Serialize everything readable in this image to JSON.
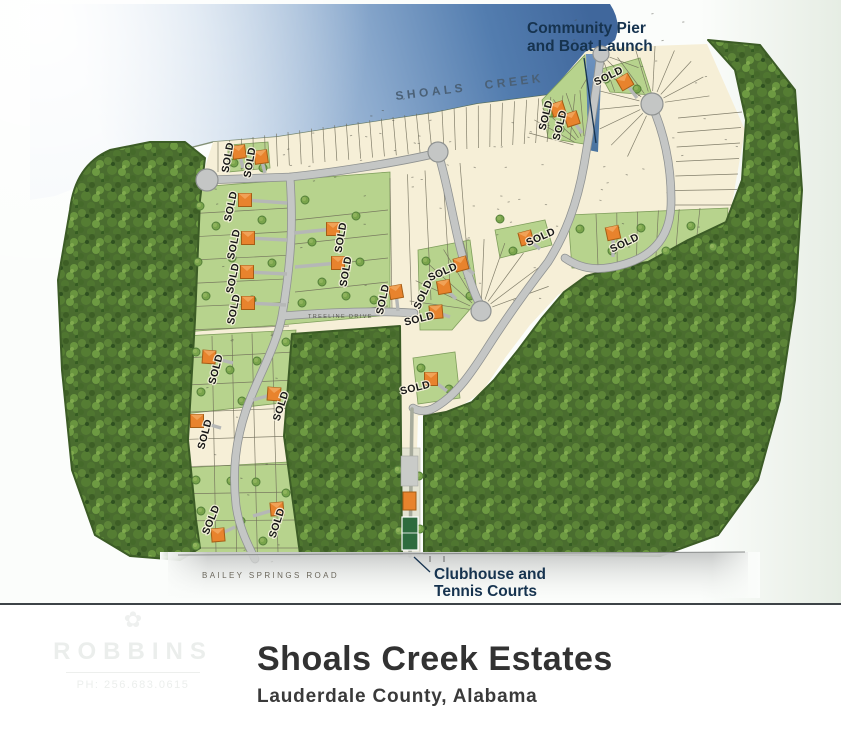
{
  "page": {
    "title": "Shoals Creek Estates",
    "subtitle": "Lauderdale County, Alabama"
  },
  "map_labels": {
    "creek_name": "SHOALS CREEK",
    "pier_label_line1": "Community Pier",
    "pier_label_line2": "and Boat Launch",
    "clubhouse_label_line1": "Clubhouse and",
    "clubhouse_label_line2": "Tennis Courts",
    "bailey_road": "BAILEY SPRINGS ROAD",
    "treeline_drive": "TREELINE DRIVE",
    "sold_text": "SOLD"
  },
  "watermark": {
    "name": "ROBBINS",
    "phone": "PH: 256.683.0615"
  },
  "colors": {
    "water_deep": "#40679c",
    "water_light": "#f3f7fa",
    "forest_green": "#4a6d2f",
    "lot_cream": "#f6efd7",
    "lot_green": "#b7d38d",
    "road_gray": "#c4c6c5",
    "road_edge": "#8f9291",
    "sold_orange": "#e8832d",
    "sold_orange_border": "#a55d15",
    "sold_roof_highlight": "#f2a55c",
    "callout_navy": "#16334f",
    "title_text": "#323232",
    "tennis_court_green": "#2e6b3e"
  },
  "sold_markers": [
    {
      "x": 239,
      "y": 152,
      "hr": -8,
      "ldx": -8,
      "ldy": 6,
      "lrot": -80,
      "d": [
        4,
        16
      ]
    },
    {
      "x": 261,
      "y": 157,
      "hr": -8,
      "ldx": -8,
      "ldy": 6,
      "lrot": -80,
      "d": [
        4,
        16
      ]
    },
    {
      "x": 245,
      "y": 200,
      "hr": 0,
      "ldx": -11,
      "ldy": 7,
      "lrot": -78,
      "d": [
        42,
        3
      ]
    },
    {
      "x": 248,
      "y": 238,
      "hr": 0,
      "ldx": -11,
      "ldy": 7,
      "lrot": -78,
      "d": [
        39,
        2
      ]
    },
    {
      "x": 247,
      "y": 272,
      "hr": 0,
      "ldx": -11,
      "ldy": 7,
      "lrot": -78,
      "d": [
        40,
        2
      ]
    },
    {
      "x": 248,
      "y": 303,
      "hr": 0,
      "ldx": -11,
      "ldy": 7,
      "lrot": -78,
      "d": [
        38,
        2
      ]
    },
    {
      "x": 333,
      "y": 229,
      "hr": 0,
      "ldx": 11,
      "ldy": 9,
      "lrot": -80,
      "d": [
        -39,
        4
      ]
    },
    {
      "x": 338,
      "y": 263,
      "hr": 0,
      "ldx": 11,
      "ldy": 9,
      "lrot": -80,
      "d": [
        -43,
        4
      ]
    },
    {
      "x": 396,
      "y": 292,
      "hr": -10,
      "ldx": -10,
      "ldy": 8,
      "lrot": -78,
      "d": [
        2,
        19
      ]
    },
    {
      "x": 526,
      "y": 238,
      "hr": -15,
      "ldx": 16,
      "ldy": 2,
      "lrot": -24,
      "d": [
        14,
        11
      ]
    },
    {
      "x": 461,
      "y": 264,
      "hr": -15,
      "ldx": -17,
      "ldy": 11,
      "lrot": -24,
      "d": [
        13,
        10
      ]
    },
    {
      "x": 444,
      "y": 287,
      "hr": -10,
      "ldx": -18,
      "ldy": 9,
      "lrot": -65,
      "d": [
        12,
        12
      ]
    },
    {
      "x": 436,
      "y": 312,
      "hr": -5,
      "ldx": -16,
      "ldy": 10,
      "lrot": -14,
      "d": [
        14,
        5
      ]
    },
    {
      "x": 613,
      "y": 233,
      "hr": -12,
      "ldx": 13,
      "ldy": 13,
      "lrot": -26,
      "d": [
        0,
        24
      ]
    },
    {
      "x": 558,
      "y": 109,
      "hr": -18,
      "ldx": -9,
      "ldy": 7,
      "lrot": -76,
      "d": [
        10,
        15
      ]
    },
    {
      "x": 572,
      "y": 119,
      "hr": -18,
      "ldx": -9,
      "ldy": 7,
      "lrot": -76,
      "d": [
        10,
        14
      ]
    },
    {
      "x": 625,
      "y": 82,
      "hr": -30,
      "ldx": -15,
      "ldy": -3,
      "lrot": -26,
      "d": [
        12,
        16
      ]
    },
    {
      "x": 209,
      "y": 357,
      "hr": 4,
      "ldx": 10,
      "ldy": 13,
      "lrot": -75,
      "d": [
        24,
        6
      ]
    },
    {
      "x": 274,
      "y": 394,
      "hr": 4,
      "ldx": 10,
      "ldy": 13,
      "lrot": -72,
      "d": [
        -21,
        6
      ]
    },
    {
      "x": 197,
      "y": 421,
      "hr": 0,
      "ldx": 11,
      "ldy": 14,
      "lrot": -75,
      "d": [
        24,
        7
      ]
    },
    {
      "x": 218,
      "y": 535,
      "hr": -5,
      "ldx": -4,
      "ldy": -14,
      "lrot": -68,
      "d": [
        17,
        -8
      ]
    },
    {
      "x": 277,
      "y": 509,
      "hr": -5,
      "ldx": 3,
      "ldy": 15,
      "lrot": -72,
      "d": [
        -24,
        7
      ]
    },
    {
      "x": 431,
      "y": 379,
      "hr": 0,
      "ldx": -15,
      "ldy": 12,
      "lrot": -14,
      "d": [
        16,
        12
      ]
    }
  ]
}
